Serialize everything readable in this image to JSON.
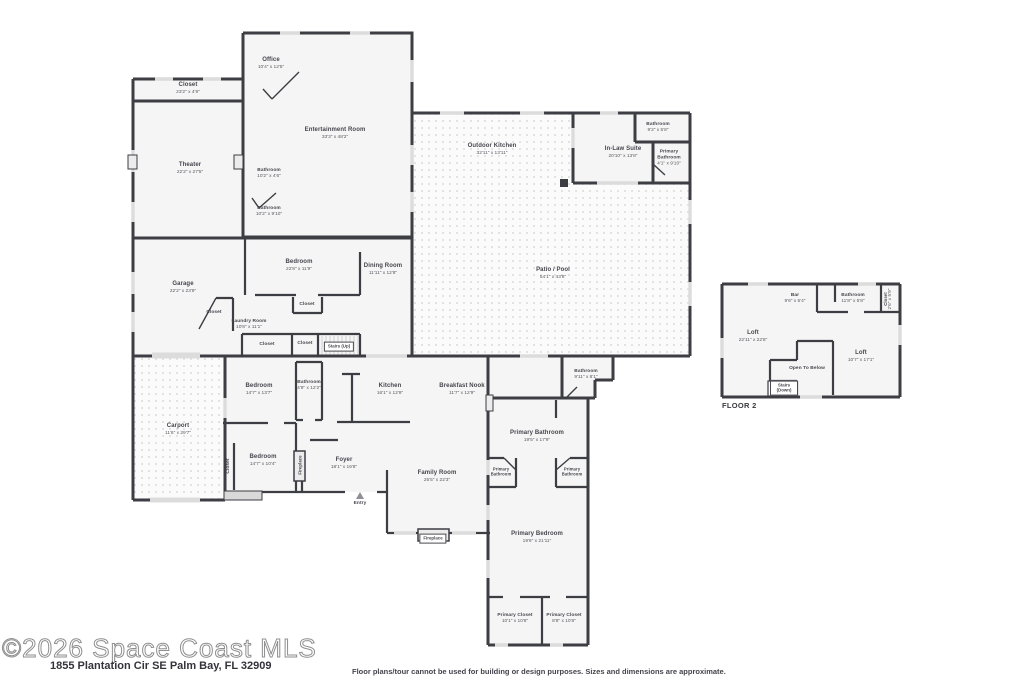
{
  "watermark": "©2026 Space Coast MLS",
  "address": "1855 Plantation Cir SE Palm Bay, FL 32909",
  "disclaimer": "Floor plans/tour cannot be used for building or design purposes. Sizes and dimensions are approximate.",
  "floor2_title": "FLOOR 2",
  "colors": {
    "wall": "#3d3d44",
    "room_fill": "#f5f5f5",
    "window": "#dcdcdc",
    "patio_dot": "#dcdcdc"
  },
  "floor1": {
    "office": {
      "name": "Office",
      "dims": "10'4\" x 12'5\""
    },
    "closet_top": {
      "name": "Closet",
      "dims": "23'2\" x 4'9\""
    },
    "entertainment": {
      "name": "Entertainment Room",
      "dims": "33'3\" x 48'2\""
    },
    "theater": {
      "name": "Theater",
      "dims": "22'2\" x 27'5\""
    },
    "bath_upper": {
      "name": "Bathroom",
      "dims": "10'2\" x 4'6\""
    },
    "bath_lower": {
      "name": "Bathroom",
      "dims": "10'2\" x 9'10\""
    },
    "outdoor_kitchen": {
      "name": "Outdoor Kitchen",
      "dims": "32'11\" x 13'11\""
    },
    "inlaw_suite": {
      "name": "In-Law Suite",
      "dims": "20'10\" x 13'8\""
    },
    "inlaw_bath": {
      "name": "Bathroom",
      "dims": "9'2\" x 5'8\""
    },
    "inlaw_primary_bath": {
      "name": "Primary Bathroom",
      "dims": "4'1\" x 9'10\""
    },
    "patio_pool": {
      "name": "Patio / Pool",
      "dims": "54'1\" x 43'8\""
    },
    "garage": {
      "name": "Garage",
      "dims": "22'2\" x 23'9\""
    },
    "bedroom_top": {
      "name": "Bedroom",
      "dims": "22'8\" x 11'9\""
    },
    "dining": {
      "name": "Dining Room",
      "dims": "11'11\" x 12'8\""
    },
    "laundry": {
      "name": "Laundry Room",
      "dims": "10'8\" x 11'1\""
    },
    "closet_garage": {
      "name": "Closet"
    },
    "closet_bedroom": {
      "name": "Closet"
    },
    "closet_hall_wide": {
      "name": "Closet"
    },
    "closet_hall_small": {
      "name": "Closet"
    },
    "stairs_up": {
      "name": "Stairs (Up)"
    },
    "carport": {
      "name": "Carport",
      "dims": "11'6\" x 29'7\""
    },
    "bedroom_mid": {
      "name": "Bedroom",
      "dims": "14'7\" x 13'7\""
    },
    "bath_mid": {
      "name": "Bathroom",
      "dims": "4'9\" x 12'2\""
    },
    "kitchen": {
      "name": "Kitchen",
      "dims": "16'1\" x 12'9\""
    },
    "breakfast_nook": {
      "name": "Breakfast Nook",
      "dims": "11'7\" x 12'9\""
    },
    "bath_hall": {
      "name": "Bathroom",
      "dims": "9'11\" x 8'1\""
    },
    "closet_bedroom_low": {
      "name": "Closet"
    },
    "bedroom_low": {
      "name": "Bedroom",
      "dims": "14'7\" x 10'4\""
    },
    "fireplace_side": {
      "name": "Fireplace"
    },
    "foyer": {
      "name": "Foyer",
      "dims": "18'1\" x 16'8\""
    },
    "entry": {
      "name": "Entry"
    },
    "family_room": {
      "name": "Family Room",
      "dims": "25'5\" x 22'3\""
    },
    "primary_bath": {
      "name": "Primary Bathroom",
      "dims": "19'5\" x 17'9\""
    },
    "primary_bath_wc_left": {
      "name": "Primary Bathroom"
    },
    "primary_bath_wc_right": {
      "name": "Primary Bathroom"
    },
    "fireplace_family": {
      "name": "Fireplace"
    },
    "primary_bedroom": {
      "name": "Primary Bedroom",
      "dims": "19'6\" x 21'11\""
    },
    "primary_closet_left": {
      "name": "Primary Closet",
      "dims": "10'1\" x 10'8\""
    },
    "primary_closet_right": {
      "name": "Primary Closet",
      "dims": "8'8\" x 10'8\""
    }
  },
  "floor2": {
    "bar": {
      "name": "Bar",
      "dims": "9'6\" x 5'4\""
    },
    "bathroom": {
      "name": "Bathroom",
      "dims": "11'8\" x 5'8\""
    },
    "closet": {
      "name": "Closet",
      "dims": "2'6\" x 5'9\""
    },
    "loft_main": {
      "name": "Loft",
      "dims": "22'11\" x 22'8\""
    },
    "loft_right": {
      "name": "Loft",
      "dims": "10'7\" x 17'1\""
    },
    "open_to_below": {
      "name": "Open To Below"
    },
    "stairs_down": {
      "name": "Stairs (Down)"
    }
  }
}
